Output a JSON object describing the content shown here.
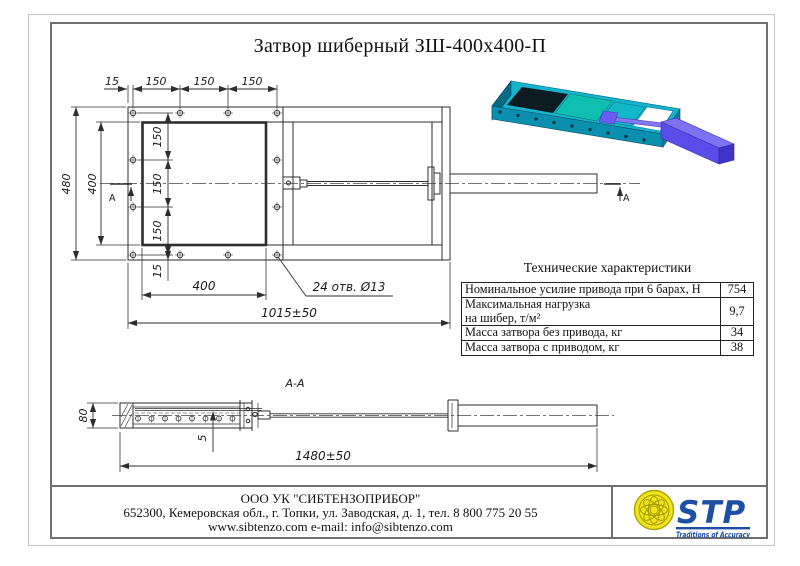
{
  "page": {
    "title": "Затвор шиберный ЗШ-400х400-П"
  },
  "main_view": {
    "top_dims": [
      "15",
      "150",
      "150",
      "150"
    ],
    "dim_outer_height": "480",
    "dim_inner_height": "400",
    "chain_dims": [
      "150",
      "150",
      "150"
    ],
    "dim_edge_offset": "15",
    "dim_opening_width": "400",
    "dim_total_length": "1015±50",
    "holes_callout": "24 отв. Ø13",
    "section_letter": "А"
  },
  "section_view": {
    "label": "А-А",
    "dim_height": "80",
    "dim_plate": "5",
    "dim_length": "1480±50"
  },
  "spec_table": {
    "title": "Технические характеристики",
    "rows": [
      {
        "label": "Номинальное усилие привода при 6 барах, Н",
        "value": "754"
      },
      {
        "label": "Максимальная нагрузка",
        "label2": "на шибер, т/м²",
        "value": "9,7"
      },
      {
        "label": "Масса затвора без привода, кг",
        "value": "34"
      },
      {
        "label": "Масса затвора с приводом, кг",
        "value": "38"
      }
    ]
  },
  "footer": {
    "company": "ООО УК \"СИБТЕНЗОПРИБОР\"",
    "address": "652300, Кемеровская обл., г. Топки, ул. Заводская, д. 1, тел. 8 800 775 20 55",
    "contacts": "www.sibtenzo.com e-mail: info@sibtenzo.com",
    "logo_text": "STP",
    "logo_tagline": "Traditions of Accuracy"
  },
  "colors": {
    "frame_teal": "#16b3cb",
    "frame_teal_dark": "#0b8fae",
    "gate_teal": "#0fc0b0",
    "actuator_blue": "#5a4ce8",
    "logo_blue": "#1d4fa5",
    "emblem_yellow": "#f2e41c",
    "line": "#2e2e2e"
  }
}
